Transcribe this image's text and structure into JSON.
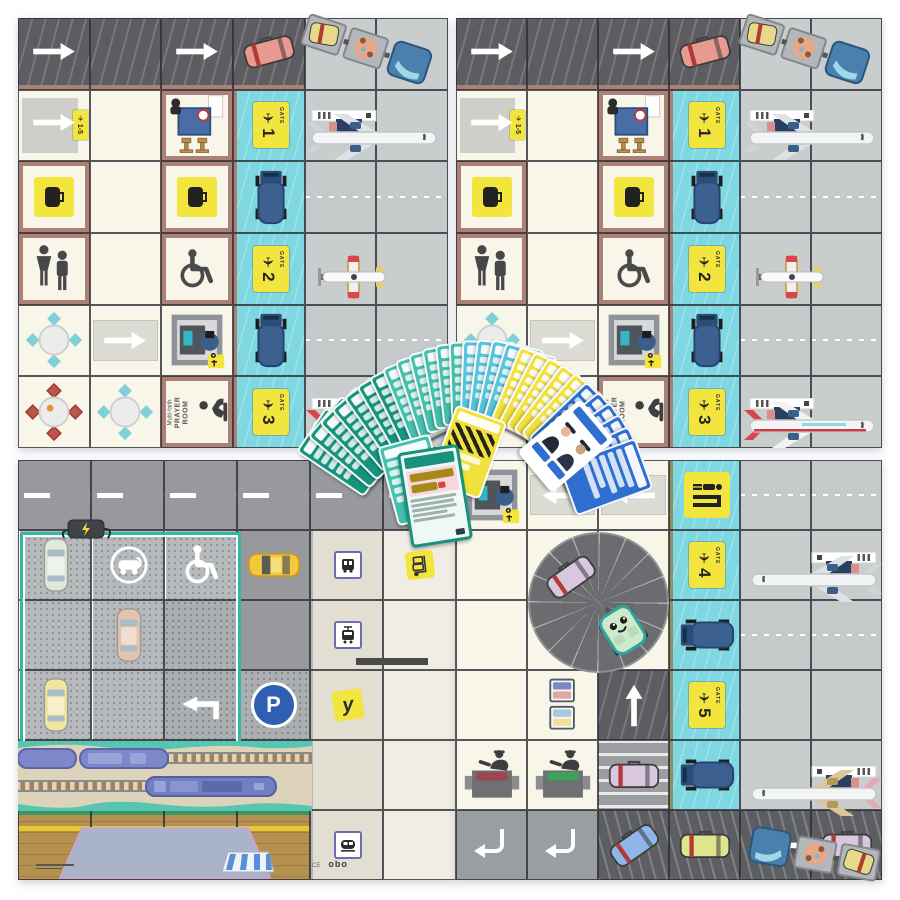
{
  "scene": "airport coding board game: four printed game mats with a fan of instruction cards",
  "palette": {
    "mat_cream": "#f8f5e9",
    "dark_road": "#5c5c61",
    "apron_gray": "#c9cdce",
    "jet_bridge_cyan": "#7fd7e2",
    "wall_brown": "#ab8175",
    "sign_yellow": "#f2e63e",
    "truck_blue": "#3c6191",
    "parking_gray": "#b7babc",
    "parking_border_teal": "#2fb9a5",
    "rail_sand": "#ddd2ba",
    "water_teal": "#56c6b2",
    "platform_wood": "#b5914f",
    "card_dark_teal": "#17947f",
    "card_teal": "#45c0ae",
    "card_cyan": "#55c4dc",
    "card_yellow": "#f0e13c",
    "card_blue": "#2e6fd0"
  },
  "texts": {
    "gate_word": "GATE",
    "gates": [
      "1",
      "2",
      "3",
      "4",
      "5"
    ],
    "gates_range": "1-5",
    "prayer_line1": "Multi-faith",
    "prayer_line2": "PRAYER",
    "prayer_line3": "ROOM",
    "parking_letter": "P",
    "y_mark": "y",
    "ce_mark": "CE",
    "brand": "obo"
  },
  "board": {
    "mats": [
      {
        "name": "board-panel-top-left",
        "panel": "terminal_h",
        "x": 18,
        "y": 18,
        "w": 430,
        "h": 430
      },
      {
        "name": "board-panel-top-right",
        "panel": "terminal_h",
        "x": 456,
        "y": 18,
        "w": 426,
        "h": 430
      },
      {
        "name": "board-panel-bottom-left",
        "panel": "city",
        "x": 18,
        "y": 460,
        "w": 438,
        "h": 420
      },
      {
        "name": "board-panel-bottom-right",
        "panel": "terminal_v",
        "x": 456,
        "y": 460,
        "w": 426,
        "h": 420
      }
    ],
    "panels": {
      "terminal_h": {
        "rows": [
          [
            {
              "t": "droad",
              "i": "arrow-right",
              "wb": 1
            },
            {
              "t": "droad",
              "wb": 1
            },
            {
              "t": "droad",
              "i": "arrow-right",
              "wb": 1
            },
            {
              "t": "droad",
              "i": "case",
              "v": "salmon",
              "rot": -15,
              "wb": 1
            },
            {
              "t": "apron"
            },
            {
              "t": "apron"
            }
          ],
          [
            {
              "t": "hall",
              "i": "hall"
            },
            {
              "t": "cream"
            },
            {
              "t": "room",
              "i": "checkin"
            },
            {
              "t": "bridge",
              "i": "gate",
              "g": "1"
            },
            {
              "t": "apron"
            },
            {
              "t": "apron"
            }
          ],
          [
            {
              "t": "room",
              "i": "bag-sign"
            },
            {
              "t": "cream"
            },
            {
              "t": "room",
              "i": "bag-sign",
              "v": "2"
            },
            {
              "t": "bridge",
              "i": "truck"
            },
            {
              "t": "taxi"
            },
            {
              "t": "taxi"
            }
          ],
          [
            {
              "t": "room",
              "i": "restroom"
            },
            {
              "t": "cream"
            },
            {
              "t": "room",
              "i": "wheelchair"
            },
            {
              "t": "bridge",
              "i": "gate",
              "g": "2"
            },
            {
              "t": "apron"
            },
            {
              "t": "apron"
            }
          ],
          [
            {
              "t": "cream",
              "i": "table",
              "v": "teal"
            },
            {
              "t": "walkway",
              "i": "arrow-right"
            },
            {
              "t": "cream",
              "i": "scanner"
            },
            {
              "t": "bridge",
              "i": "truck"
            },
            {
              "t": "taxi"
            },
            {
              "t": "taxi"
            }
          ],
          [
            {
              "t": "cream",
              "i": "table",
              "v": "red"
            },
            {
              "t": "cream",
              "i": "table",
              "v": "teal"
            },
            {
              "t": "room",
              "i": "prayer"
            },
            {
              "t": "bridge",
              "i": "gate",
              "g": "3"
            },
            {
              "t": "apron"
            },
            {
              "t": "apron"
            }
          ]
        ],
        "overlays": [
          {
            "i": "tractor",
            "x": 282,
            "y": 8,
            "rot": 18
          },
          {
            "i": "plane",
            "v": "white",
            "x": 288,
            "y": 92
          },
          {
            "i": "plane-small",
            "x": 300,
            "y": 236
          },
          {
            "i": "plane",
            "v": "red",
            "x": 288,
            "y": 380
          }
        ]
      },
      "city": {
        "rows": [
          [
            {
              "t": "roadh"
            },
            {
              "t": "roadh"
            },
            {
              "t": "roadh"
            },
            {
              "t": "roadh"
            },
            {
              "t": "roadh"
            },
            {
              "t": "roadh"
            }
          ],
          [
            {
              "t": "park",
              "i": "car",
              "v": "mint"
            },
            {
              "t": "park",
              "i": "ev-sign"
            },
            {
              "t": "park",
              "i": "disabled"
            },
            {
              "t": "roadv",
              "i": "taxi-car"
            },
            {
              "t": "side",
              "i": "vsign",
              "v": "bus"
            },
            {
              "t": "walk",
              "i": "sticker",
              "v": "bag"
            }
          ],
          [
            {
              "t": "park"
            },
            {
              "t": "park",
              "i": "car",
              "v": "pink"
            },
            {
              "t": "park2"
            },
            {
              "t": "roadv"
            },
            {
              "t": "side",
              "i": "vsign",
              "v": "tram"
            },
            {
              "t": "walk"
            }
          ],
          [
            {
              "t": "park",
              "i": "car",
              "v": "yellow"
            },
            {
              "t": "park"
            },
            {
              "t": "park2",
              "i": "turn-left"
            },
            {
              "t": "park2",
              "i": "p-sign"
            },
            {
              "t": "side",
              "i": "y-sign"
            },
            {
              "t": "walk"
            }
          ],
          [
            {
              "t": "rail"
            },
            {
              "t": "rail"
            },
            {
              "t": "rail"
            },
            {
              "t": "rail"
            },
            {
              "t": "side"
            },
            {
              "t": "walk"
            }
          ],
          [
            {
              "t": "platform"
            },
            {
              "t": "platform"
            },
            {
              "t": "platform"
            },
            {
              "t": "platform"
            },
            {
              "t": "side",
              "i": "vsign",
              "v": "train"
            },
            {
              "t": "walk"
            }
          ]
        ],
        "overlays": [
          {
            "i": "park-outline",
            "x": 2,
            "y": 72,
            "w": 215,
            "h": 210
          },
          {
            "i": "charger",
            "x": 42,
            "y": 58
          },
          {
            "i": "trains",
            "x": 0,
            "y": 281,
            "w": 294,
            "h": 70
          },
          {
            "i": "station",
            "x": 0,
            "y": 352,
            "w": 294,
            "h": 68
          },
          {
            "i": "bench",
            "x": 338,
            "y": 198,
            "w": 72,
            "h": 7
          },
          {
            "i": "credits",
            "x": 18,
            "y": 404
          },
          {
            "i": "marks",
            "x": 294,
            "y": 399
          }
        ]
      },
      "terminal_v": {
        "rows": [
          [
            {
              "t": "cream",
              "i": "scanner"
            },
            {
              "t": "walkway",
              "i": "arrow-left"
            },
            {
              "t": "walkway",
              "i": "arrow-left"
            },
            {
              "t": "bridgev",
              "i": "scan-sign"
            },
            {
              "t": "taxi"
            },
            {
              "t": "taxi"
            }
          ],
          [
            {
              "t": "cream"
            },
            {
              "t": "cream"
            },
            {
              "t": "cream"
            },
            {
              "t": "bridgev",
              "i": "gate",
              "g": "4"
            },
            {
              "t": "apron"
            },
            {
              "t": "apron"
            }
          ],
          [
            {
              "t": "cream"
            },
            {
              "t": "cream"
            },
            {
              "t": "cream"
            },
            {
              "t": "bridgev",
              "i": "truck",
              "v": "left"
            },
            {
              "t": "taxi"
            },
            {
              "t": "taxi"
            }
          ],
          [
            {
              "t": "cream"
            },
            {
              "t": "cream",
              "i": "trolleys"
            },
            {
              "t": "droad",
              "i": "arrow-up"
            },
            {
              "t": "bridgev",
              "i": "gate",
              "g": "5"
            },
            {
              "t": "apron"
            },
            {
              "t": "apron"
            }
          ],
          [
            {
              "t": "cream",
              "i": "passport",
              "v": "red"
            },
            {
              "t": "cream",
              "i": "passport",
              "v": "green"
            },
            {
              "t": "crosswalk",
              "i": "case",
              "v": "lavender"
            },
            {
              "t": "bridgev",
              "i": "truck",
              "v": "left"
            },
            {
              "t": "apron"
            },
            {
              "t": "apron"
            }
          ],
          [
            {
              "t": "gray",
              "i": "hook-left"
            },
            {
              "t": "gray",
              "i": "hook-left"
            },
            {
              "t": "belt",
              "i": "case",
              "v": "blue",
              "rot": -35
            },
            {
              "t": "belt",
              "i": "case",
              "v": "yellow"
            },
            {
              "t": "belt",
              "i": "arrow-left"
            },
            {
              "t": "belt",
              "i": "case",
              "v": "lavender"
            }
          ]
        ],
        "overlays": [
          {
            "i": "carousel",
            "x": 72,
            "y": 72,
            "w": 141,
            "h": 141
          },
          {
            "i": "plane",
            "v": "white",
            "x": 286,
            "y": 92,
            "flip": 1
          },
          {
            "i": "plane",
            "v": "pink",
            "x": 286,
            "y": 306,
            "flip": 1
          },
          {
            "i": "tractor",
            "x": 292,
            "y": 372,
            "rot": 10,
            "flip": 1
          }
        ]
      }
    }
  },
  "cards": {
    "kinds": {
      "dt": "instruction-card-dark-teal",
      "lt": "instruction-card-teal",
      "cy": "instruction-card-cyan",
      "ye": "instruction-card-yellow",
      "ze": "instruction-card-yellow-pattern",
      "bl": "role-card-blue",
      "pi": "role-card-pilots",
      "co": "challenge-card-front"
    },
    "deck": [
      {
        "x": 345,
        "y": 452,
        "r": -56,
        "k": "dt"
      },
      {
        "x": 356,
        "y": 442,
        "r": -50,
        "k": "dt"
      },
      {
        "x": 367,
        "y": 433,
        "r": -45,
        "k": "dt"
      },
      {
        "x": 378,
        "y": 424,
        "r": -40,
        "k": "dt"
      },
      {
        "x": 389,
        "y": 416,
        "r": -35,
        "k": "dt"
      },
      {
        "x": 400,
        "y": 409,
        "r": -30,
        "k": "dt"
      },
      {
        "x": 411,
        "y": 403,
        "r": -26,
        "k": "dt"
      },
      {
        "x": 422,
        "y": 397,
        "r": -22,
        "k": "lt"
      },
      {
        "x": 433,
        "y": 392,
        "r": -18,
        "k": "lt"
      },
      {
        "x": 444,
        "y": 388,
        "r": -14,
        "k": "lt"
      },
      {
        "x": 455,
        "y": 385,
        "r": -10,
        "k": "lt"
      },
      {
        "x": 466,
        "y": 383,
        "r": -6,
        "k": "lt"
      },
      {
        "x": 477,
        "y": 382,
        "r": -2,
        "k": "lt"
      },
      {
        "x": 488,
        "y": 382,
        "r": 2,
        "k": "cy"
      },
      {
        "x": 499,
        "y": 383,
        "r": 7,
        "k": "cy"
      },
      {
        "x": 510,
        "y": 385,
        "r": 12,
        "k": "cy"
      },
      {
        "x": 520,
        "y": 389,
        "r": 17,
        "k": "cy"
      },
      {
        "x": 530,
        "y": 394,
        "r": 22,
        "k": "ye"
      },
      {
        "x": 540,
        "y": 400,
        "r": 27,
        "k": "ye"
      },
      {
        "x": 550,
        "y": 406,
        "r": 32,
        "k": "ye"
      },
      {
        "x": 559,
        "y": 413,
        "r": 37,
        "k": "ye"
      },
      {
        "x": 568,
        "y": 421,
        "r": 42,
        "k": "ye"
      },
      {
        "x": 576,
        "y": 429,
        "r": 46,
        "k": "bl"
      },
      {
        "x": 584,
        "y": 438,
        "r": 51,
        "k": "bl"
      },
      {
        "x": 591,
        "y": 447,
        "r": 56,
        "k": "bl"
      },
      {
        "x": 597,
        "y": 457,
        "r": 61,
        "k": "bl"
      },
      {
        "x": 602,
        "y": 467,
        "r": 66,
        "k": "bl"
      },
      {
        "x": 606,
        "y": 477,
        "r": 70,
        "k": "bl"
      },
      {
        "x": 468,
        "y": 452,
        "r": 20,
        "k": "ze"
      },
      {
        "x": 566,
        "y": 446,
        "r": 50,
        "k": "pi"
      },
      {
        "x": 414,
        "y": 480,
        "r": -15,
        "k": "lt"
      },
      {
        "x": 435,
        "y": 496,
        "r": -9,
        "k": "co"
      }
    ]
  }
}
